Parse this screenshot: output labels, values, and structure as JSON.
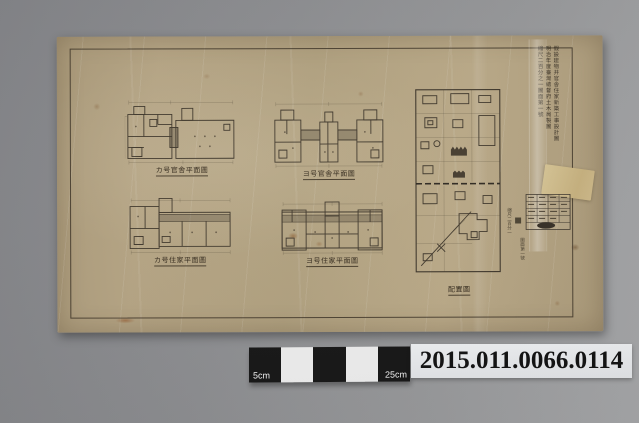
{
  "photo": {
    "catalog_number": "2015.011.0066.0114",
    "scale_bar": {
      "left_label": "5cm",
      "right_label": "25cm"
    },
    "colors": {
      "background_gray": "#8c8d90",
      "paper_tan": "#b2a180",
      "ink": "#3e362a",
      "label_background": "#eceef0",
      "scalebar_black": "#141414"
    }
  },
  "drawing": {
    "plans": [
      {
        "caption": "カ号官舎平面圖"
      },
      {
        "caption": "ヨ号官舎平面圖"
      },
      {
        "caption": "カ号住家平面圖"
      },
      {
        "caption": "ヨ号住家平面圖"
      }
    ],
    "site_plan": {
      "caption": "配置圖"
    },
    "margin_annotation": {
      "columns": [
        "假設建物并官舎住家新築工事設計圖",
        "明治年度臺灣總督府土木局製圖",
        "縮尺二百分之一圖面第一號"
      ]
    },
    "scale_note": "縮尺二百分一",
    "sheet_note": "圖面第一號"
  }
}
